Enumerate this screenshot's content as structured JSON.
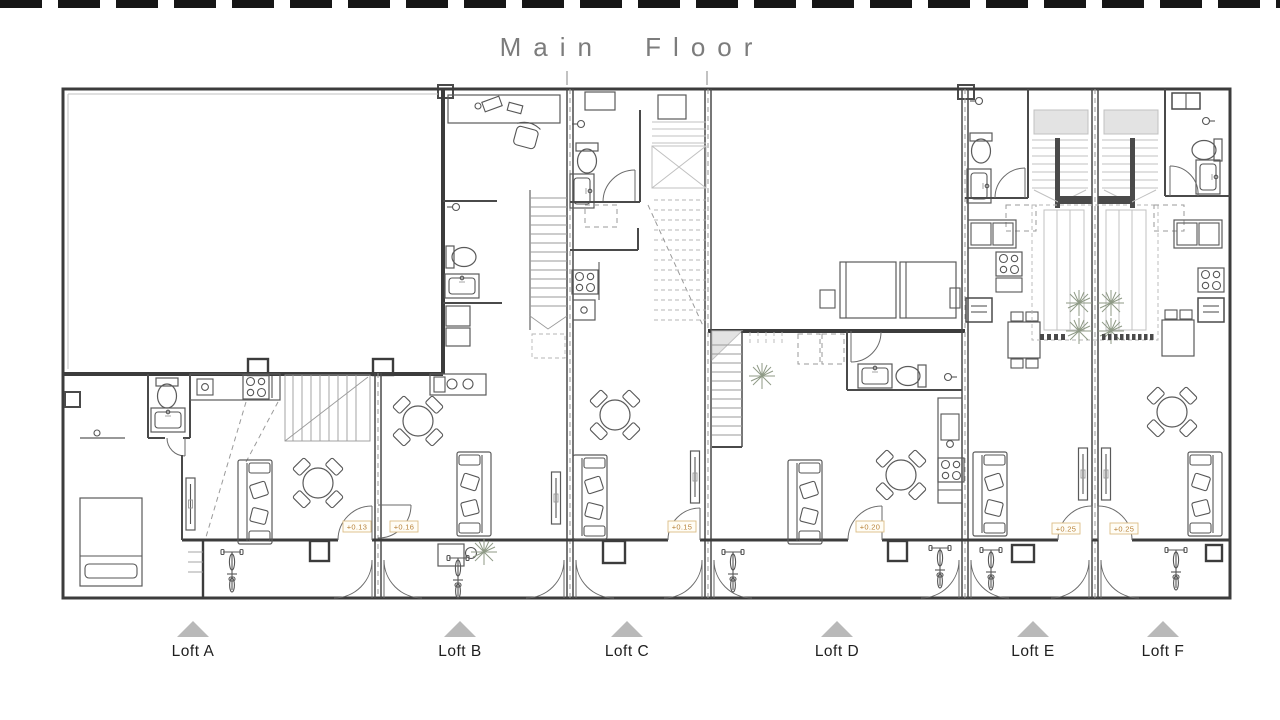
{
  "title": "Main Floor",
  "plan": {
    "lofts": [
      {
        "label": "Loft A",
        "elevation": "+0.13"
      },
      {
        "label": "Loft B",
        "elevation": "+0.16"
      },
      {
        "label": "Loft C",
        "elevation": "+0.15"
      },
      {
        "label": "Loft D",
        "elevation": "+0.20"
      },
      {
        "label": "Loft E",
        "elevation": "+0.25"
      },
      {
        "label": "Loft F",
        "elevation": "+0.25"
      }
    ]
  },
  "icons": {
    "loft_marker": "up-triangle",
    "plant": "plant-burst",
    "bike": "bicycle-top-view",
    "door": "quarter-arc"
  },
  "colors": {
    "wall": "#3c3c3c",
    "elevation_text": "#b9843c",
    "elevation_border": "#dcbd86",
    "marker_triangle": "#b9b9b9",
    "title_text": "#7c7c7c"
  }
}
